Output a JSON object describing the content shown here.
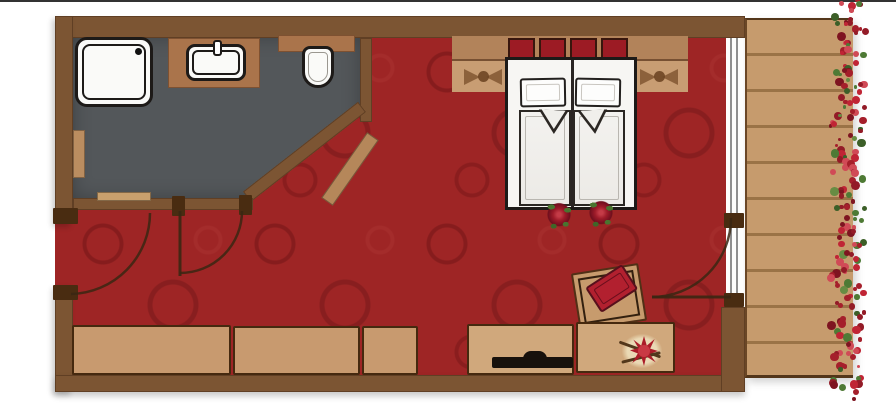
{
  "plan": {
    "kind": "hotel-room-floor-plan",
    "rooms": [
      {
        "name": "bathroom",
        "fixtures": [
          "shower",
          "washbasin-on-counter",
          "toilet",
          "towel-rail",
          "wall-shelf",
          "diagonal-shelf"
        ]
      },
      {
        "name": "bedroom",
        "furniture": [
          "double-bed",
          "two-pillows",
          "two-duvets-with-rose-print",
          "headboard-shelf-with-red-cushions",
          "nightstand-band-with-rose-shadows",
          "wardrobe-three-sections",
          "sideboard-with-tv",
          "sideboard-with-flower-bouquet",
          "tilted-armchair-with-red-cushion"
        ]
      },
      {
        "name": "balcony",
        "features": [
          "wood-plank-deck",
          "red-flower-border"
        ]
      }
    ],
    "doors": [
      "entrance-door-left-wall",
      "bathroom-door",
      "balcony-glass-door"
    ]
  },
  "palette": {
    "wall": "#7c5533",
    "post": "#492c11",
    "carpet": "#9e2525",
    "bathfloor": "#53575a",
    "counter": "#aa744b",
    "fixture-white": "#fafaf8",
    "wardrobe": "#c89a6f",
    "desk": "#d0a87c",
    "deck": "#c69b6d",
    "headboard-shelf": "#b2835a",
    "headboard-band": "#c89d73",
    "red-cushion": "#9c1b24",
    "rose": "#ab1c28",
    "bed-white": "#f7f6f3",
    "outline": "#1d1a18",
    "glass-line": "#8f8f8f"
  },
  "elements": {
    "headboard_cushions": 4,
    "pillows": 2,
    "duvet_roses": 2,
    "wardrobe_sections": 3,
    "flower_dots": 175,
    "flower_reds": [
      "#a51f2b",
      "#c02535",
      "#7e1420",
      "#931b27",
      "#d04a56"
    ],
    "flower_greens": [
      "#4e7a35",
      "#3c5f28",
      "#678c43"
    ]
  }
}
